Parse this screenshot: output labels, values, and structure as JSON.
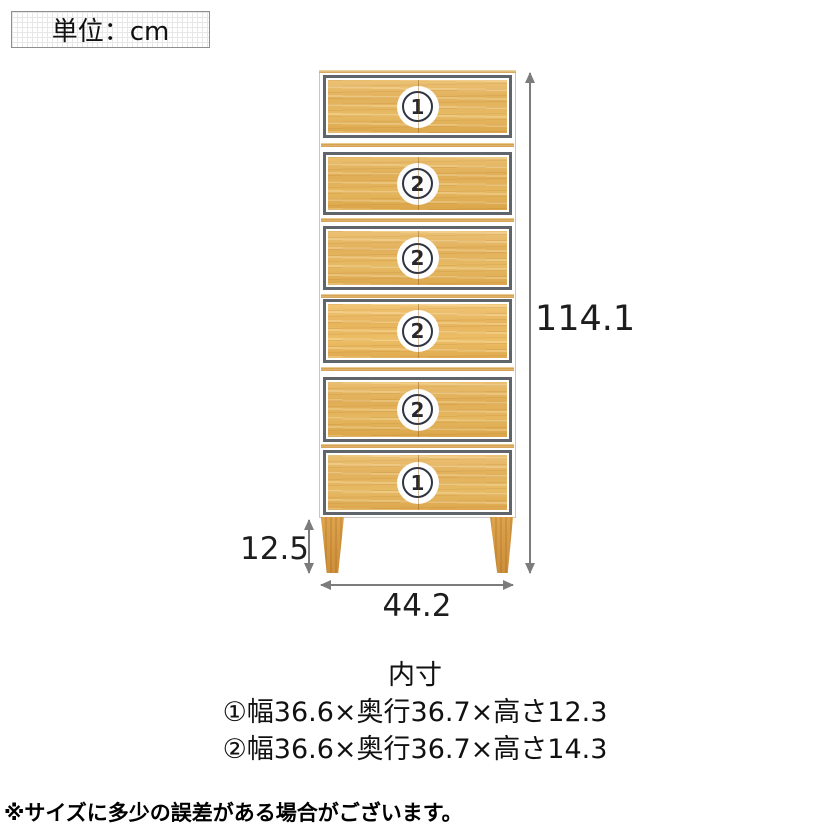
{
  "unit_box": {
    "label": "単位：cm"
  },
  "chest": {
    "drawers": [
      {
        "num": "1"
      },
      {
        "num": "2"
      },
      {
        "num": "2"
      },
      {
        "num": "2"
      },
      {
        "num": "2"
      },
      {
        "num": "1"
      }
    ]
  },
  "dimensions": {
    "height": "114.1",
    "leg_height": "12.5",
    "width": "44.2"
  },
  "inner_size": {
    "title": "内寸",
    "drawer1": "①幅36.6×奥行36.7×高さ12.3",
    "drawer2": "②幅36.6×奥行36.7×高さ14.3"
  },
  "note": "※サイズに多少の誤差がある場合がございます。",
  "colors": {
    "wood": "#e2b05a",
    "drawer_frame": "#60656b",
    "arrow": "#7c7c7c",
    "text": "#1c1c1c"
  }
}
